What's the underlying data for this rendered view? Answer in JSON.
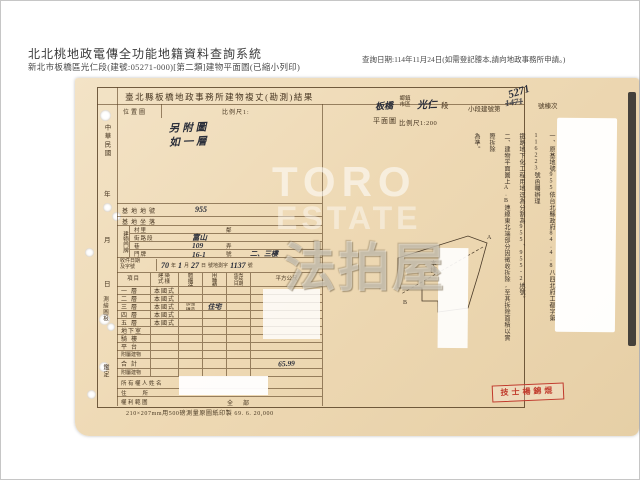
{
  "header": {
    "system_title": "北北桃地政電傳全功能地籍資料查詢系統",
    "subtitle": "新北市板橋區光仁段(建號:05271-000)[第二類]建物平面圖(已縮小列印)",
    "query_note": "查詢日期:114年11月24日(如需登記謄本,請向地政事務所申請。)"
  },
  "form": {
    "title": "臺北縣板橋地政事務所建物複丈(勘測)結果",
    "township_value": "板橋",
    "township_label": "鄉鎮市區",
    "section_value": "光仁",
    "section_label": "段",
    "building_no_label": "小段建號第",
    "building_no_value": "5271",
    "building_no_old": "1471",
    "building_no_suffix": "號棟次",
    "margin_labels": {
      "era": "中華民國",
      "year": "年",
      "month": "月",
      "day": "日",
      "survey": "測繪圖根",
      "verify": "鑑定"
    },
    "location_label": "位置圖",
    "location_scale_label": "比例尺1:",
    "location_note1": "另附圖",
    "location_note2": "如一層",
    "plan_label": "平面圖",
    "plan_scale": "比例尺1:200",
    "fields": {
      "lot_label": "基地地號",
      "lot_value": "955",
      "site_label": "基地坐落",
      "door_label": "建物門牌",
      "door_r1_label": "村里",
      "door_r1_extra": "鄰",
      "door_r2_label": "街路段",
      "door_r2_value": "富山",
      "door_r3_label": "巷",
      "door_r3_value": "109",
      "door_r3_extra": "弄",
      "door_r4_label": "門牌",
      "door_r4_value": "16-1",
      "door_r4_extra": "號",
      "door_r4_floors": "二、三樓",
      "receipt_label1": "收件日期",
      "receipt_label2": "及字號",
      "receipt_d1": "70",
      "receipt_u1": "年",
      "receipt_d2": "1",
      "receipt_u2": "月",
      "receipt_d3": "27",
      "receipt_u3": "日",
      "receipt_mid": "號地測字",
      "receipt_no": "1137",
      "receipt_suffix": "號"
    },
    "floor_table": {
      "headers": [
        "項目",
        "建築式樣",
        "主體構造",
        "使用種類",
        "建築完成日期",
        "平方公尺"
      ],
      "rows": [
        {
          "label": "一層",
          "style": "本國式",
          "structure": "",
          "use": "",
          "date": "",
          "area": ""
        },
        {
          "label": "二層",
          "style": "本國式",
          "structure": "",
          "use": "",
          "date": "",
          "area": ""
        },
        {
          "label": "三層",
          "style": "本國式",
          "structure": "加強磚造",
          "use": "住宅",
          "date": "",
          "area": ""
        },
        {
          "label": "四層",
          "style": "本國式",
          "structure": "",
          "use": "",
          "date": "",
          "area": ""
        },
        {
          "label": "五層",
          "style": "本國式",
          "structure": "",
          "use": "",
          "date": "",
          "area": ""
        },
        {
          "label": "地下室",
          "style": "",
          "structure": "",
          "use": "",
          "date": "",
          "area": ""
        },
        {
          "label": "騎樓",
          "style": "",
          "structure": "",
          "use": "",
          "date": "",
          "area": ""
        },
        {
          "label": "平台",
          "style": "",
          "structure": "",
          "use": "",
          "date": "",
          "area": ""
        },
        {
          "label": "附屬建物",
          "style": "",
          "structure": "",
          "use": "",
          "date": "",
          "area": ""
        },
        {
          "label": "合計",
          "style": "",
          "structure": "",
          "use": "",
          "date": "",
          "area": "65.99"
        },
        {
          "label": "附屬建物",
          "style": "",
          "structure": "",
          "use": "",
          "date": "",
          "area": ""
        }
      ],
      "owner_label": "所有權人姓名",
      "address_label": "住所",
      "rights_label": "權利範圍",
      "rights_value": "全部"
    },
    "notes": {
      "line1": "一、原基地號955依台北縣政府84.4.8八四北府工都字第116223號函囑辦理",
      "line2": "鐵路地下化工程用地逕為分割為955、955-2地號。",
      "line3": "二、建物平面圖上A.B連線東北端部分因徵收拆除,至其拆除面積以實際拆除",
      "line4": "為準。"
    },
    "drawing": {
      "building_label": "本棟",
      "point_a": "A",
      "point_b": "B"
    },
    "stamp": "技士楊錦焜",
    "footer_note": "210×207mm用500磅測量原圖紙印製 69. 6. 20,000"
  },
  "watermark": {
    "line1": "TORO",
    "line2": "ESTATE",
    "line3": "法拍屋"
  }
}
